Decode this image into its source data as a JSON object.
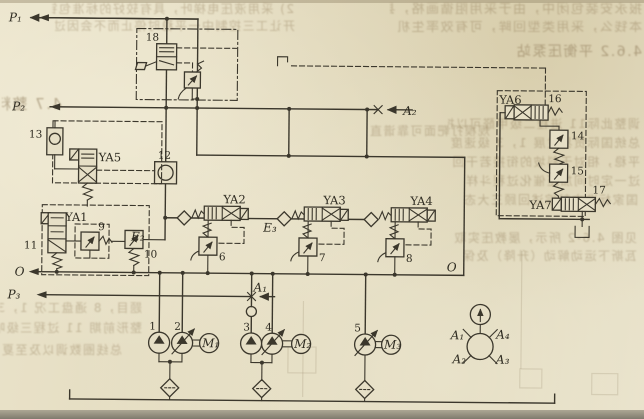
{
  "colors": {
    "paper": "#e5dec4",
    "ink": "#3b372c"
  },
  "labels": {
    "p1": "P₁",
    "p2": "P₂",
    "p3": "P₃",
    "o_left": "O",
    "o_right": "O",
    "a1": "A₁",
    "a2": "A₂",
    "e2": "E₂",
    "e3": "E₃",
    "ya1": "YA1",
    "ya2": "YA2",
    "ya3": "YA3",
    "ya4": "YA4",
    "ya5": "YA5",
    "ya6": "YA6",
    "ya7": "YA7",
    "m1": "M₁",
    "m2": "M₂",
    "m3": "M₃",
    "c1": "1",
    "c2": "2",
    "c3": "3",
    "c4": "4",
    "c5": "5",
    "c6": "6",
    "c7": "7",
    "c8": "8",
    "c9": "9",
    "c10": "10",
    "c11": "11",
    "c12": "12",
    "c13": "13",
    "c14": "14",
    "c15": "15",
    "c16": "16",
    "c17": "17",
    "c18": "18",
    "port_a1": "A₁",
    "port_a2": "A₂",
    "port_a3": "A₃",
    "port_a4": "A₄"
  },
  "bleed": [
    {
      "t": "报永安装包闭中，由于采用阻循画格，县设成"
    },
    {
      "t": "本钱么，采用类型回眸，可有效率生机硬"
    },
    {
      "t": "4.6.2 平衡压泵站"
    },
    {
      "t": "2) 采用液压电梯叶，具有较好的标准包针"
    },
    {
      "t": "开让工三控制中一平稳时停止而不会因过日至"
    },
    {
      "t": "4.7 整料"
    },
    {
      "t": "调整此际11 进程二级甲醛可以控制"
    },
    {
      "t": "总统国际贸易发展 1，3 级速度，按动"
    },
    {
      "t": "平稳，相对于斜坡的衔接若干回些"
    },
    {
      "t": "过一定时间加压催化过程斗样"
    },
    {
      "t": "国家标准文献综述回顾三大态"
    },
    {
      "t": "见图 4.6-2 所示，屡教压实取"
    },
    {
      "t": "瓦斯下运动解动（升降）及保"
    },
    {
      "t": "题目，8 通盘工况 1，3 电压"
    },
    {
      "t": "整形前期 11 过程三级响应"
    },
    {
      "t": "总线圈数调以及至夏 1，3 台"
    },
    {
      "t": "规模打靶面可靠谱直"
    }
  ]
}
